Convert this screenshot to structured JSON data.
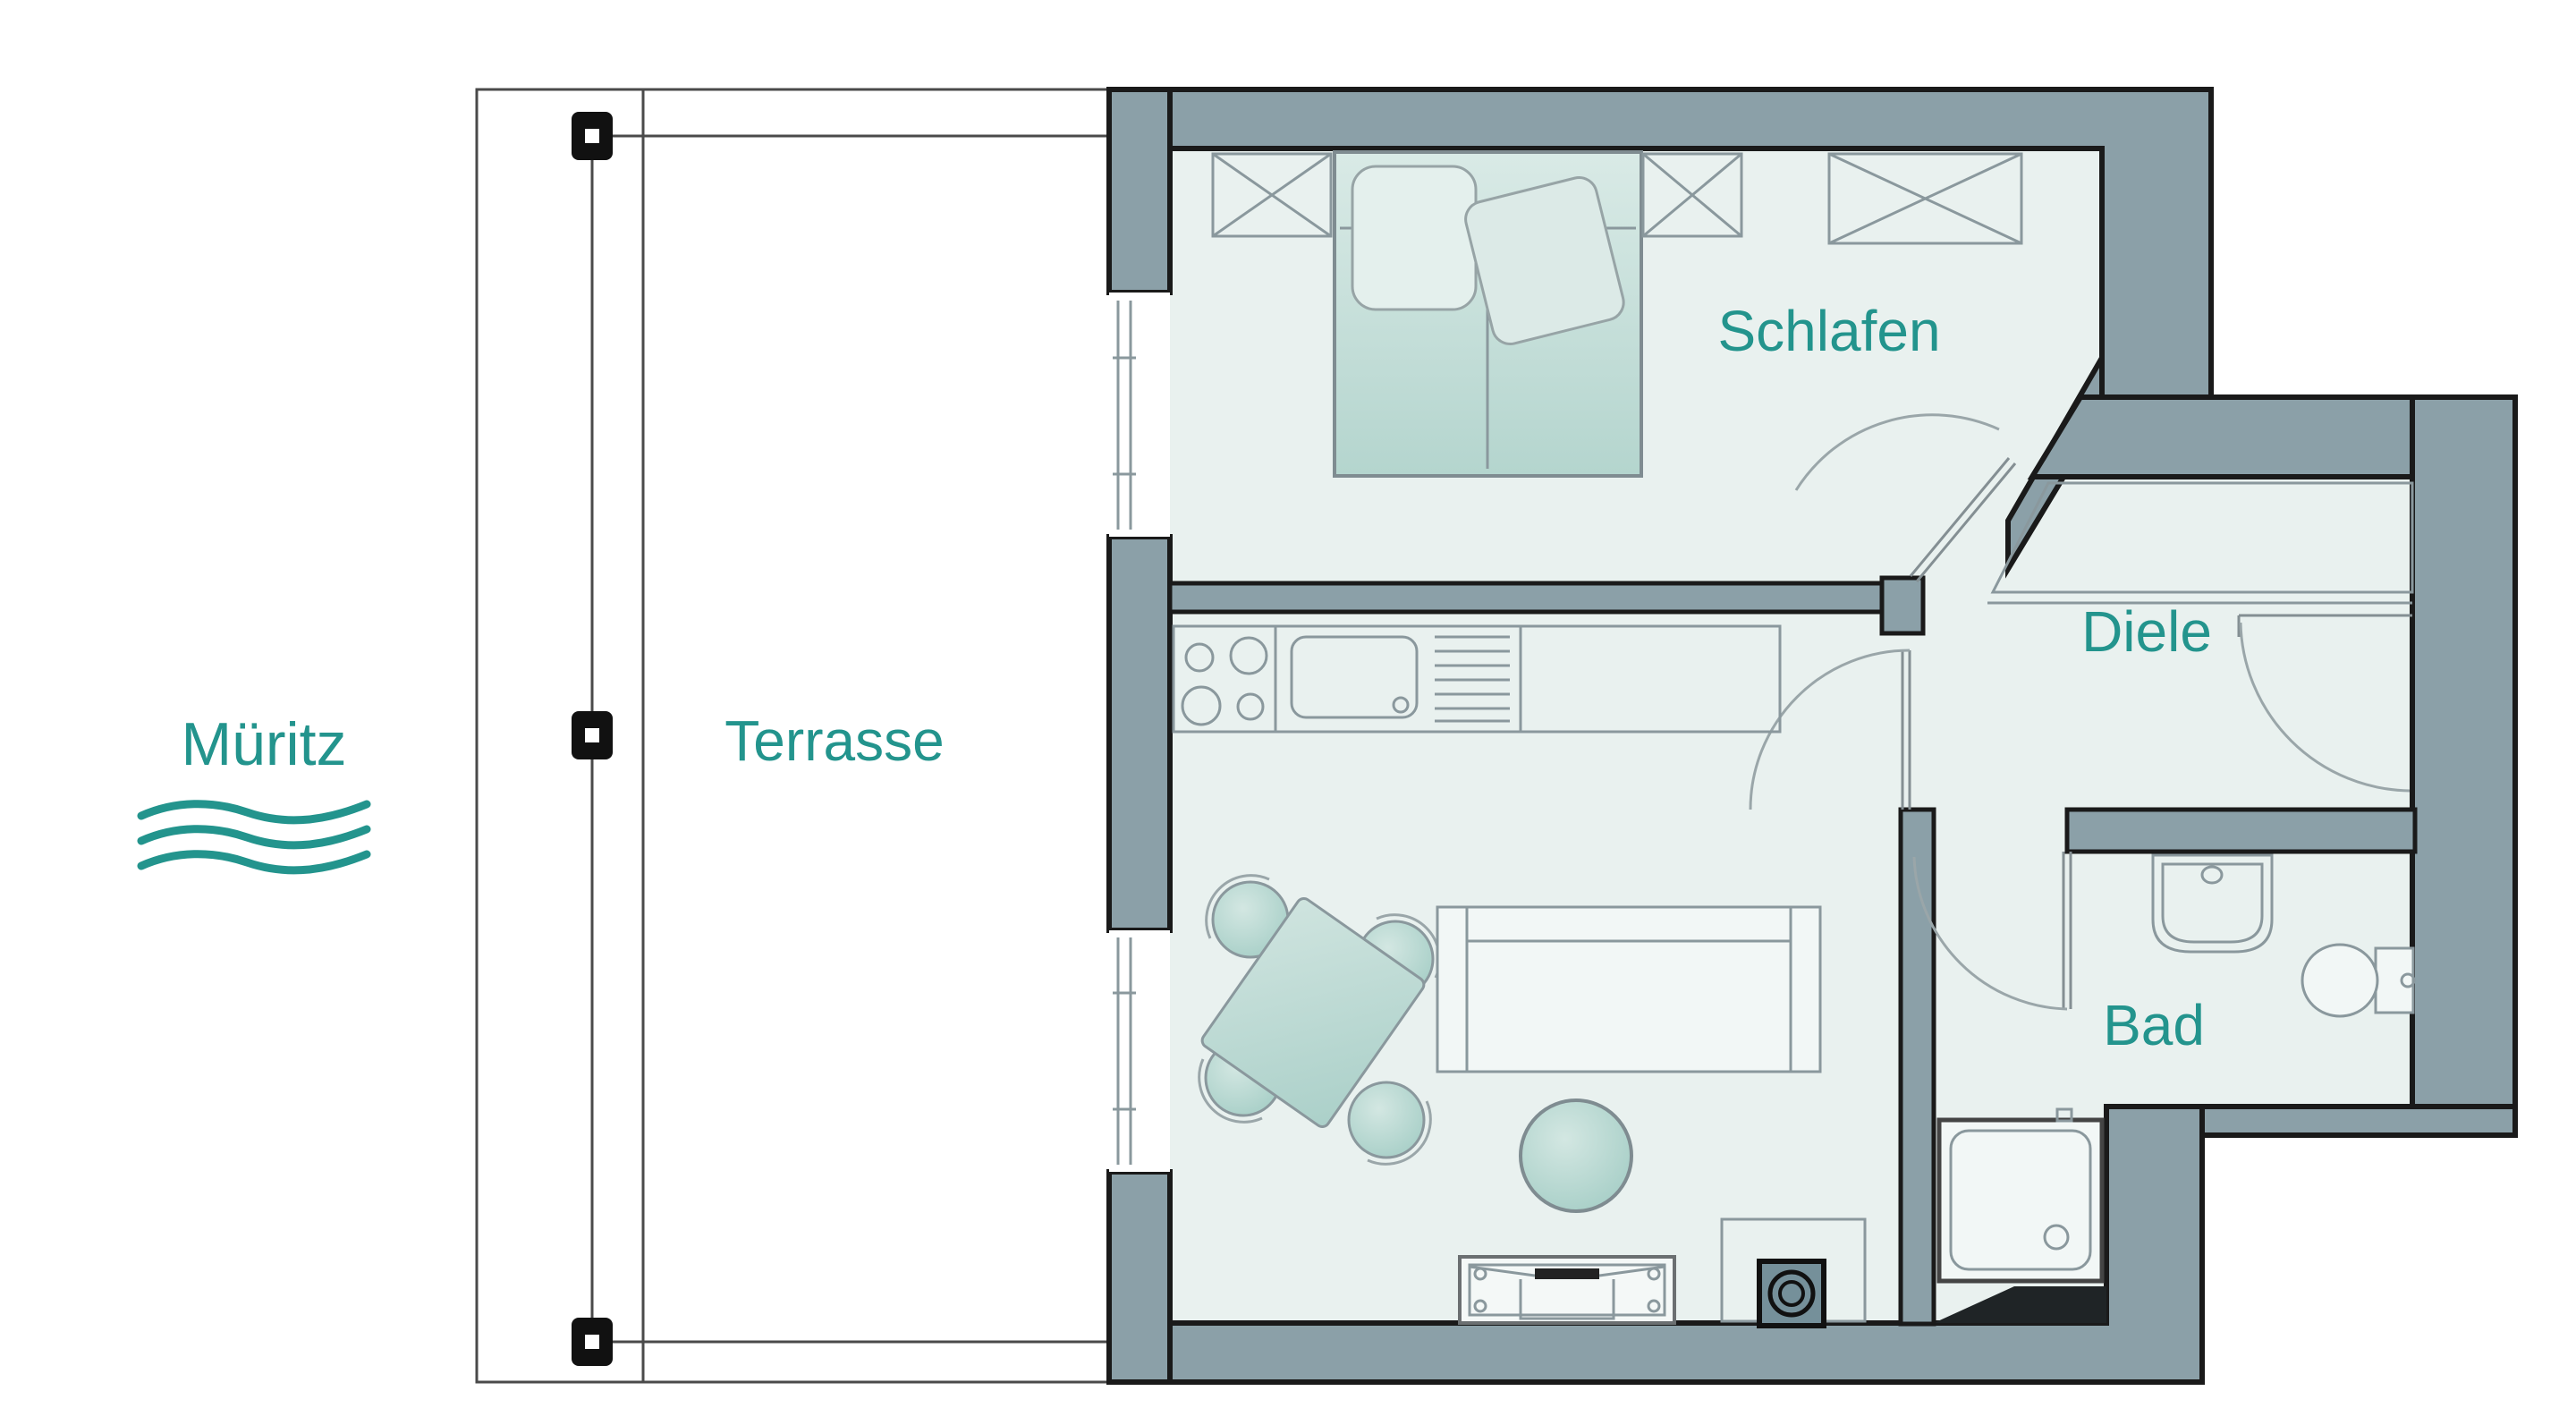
{
  "plan": {
    "type": "apartment-floor-plan",
    "labels": {
      "lake": "Müritz",
      "terrace": "Terrasse",
      "bedroom": "Schlafen",
      "hall": "Diele",
      "bath": "Bad"
    },
    "colors": {
      "label_teal": "#23948d",
      "wall_fill": "#8ba0a8",
      "wall_outline": "#1a1a1a",
      "floor": "#e9f1ef",
      "furniture_line": "#8a989d",
      "furniture_teal": "#b7d8d2",
      "post_black": "#111111",
      "background": "#ffffff"
    },
    "icons": {
      "lake_waves": "water-waves-icon",
      "terrace_post": "square-post-marker",
      "closet_symbol": "crossed-rectangle-icon",
      "door_swing": "quarter-arc-door-icon"
    },
    "furniture": {
      "bedroom": [
        "wardrobe-crossed-box",
        "double-bed",
        "wardrobe-crossed-box",
        "wardrobe-crossed-box"
      ],
      "kitchen": [
        "cooktop-4-burners",
        "sink-with-drainer",
        "counter"
      ],
      "living": [
        "dining-table-4-chairs",
        "sofa",
        "round-side-table",
        "tv-sideboard",
        "wood-stove"
      ],
      "bath": [
        "washbasin",
        "toilet",
        "shower"
      ]
    }
  }
}
